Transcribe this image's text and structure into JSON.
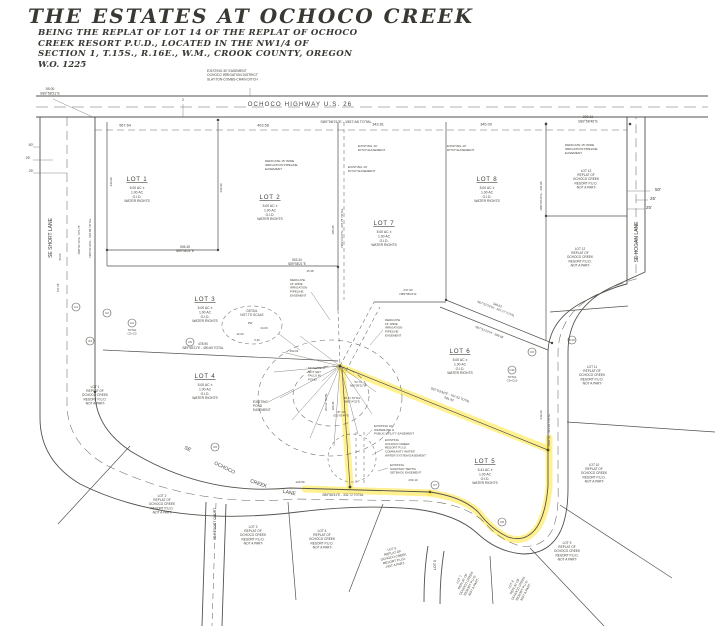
{
  "colors": {
    "paper": "#ffffff",
    "ink": "#55524c",
    "highlight": "#ffe84a"
  },
  "title_block": {
    "title": "THE ESTATES AT OCHOCO CREEK",
    "line1": "BEING THE REPLAT OF LOT 14 OF THE REPLAT OF OCHOCO",
    "line2": "CREEK RESORT P.U.D., LOCATED IN THE NW1/4 OF",
    "line3": "SECTION 1, T.15S., R.16E., W.M., CROOK COUNTY, OREGON",
    "line4": "W.O. 1225"
  },
  "map_labels": [
    {
      "n": "road-ochoco-highway-label",
      "t": "OCHOCO HIGHWAY U.S. 26",
      "x": 300,
      "y": 106,
      "s": 6,
      "ls": 1.2
    },
    {
      "n": "bearing-highway-total",
      "t": "S89°58'21\"E  -  1557.68 TOTAL",
      "x": 346,
      "y": 123,
      "s": 3.8
    },
    {
      "n": "dim-567-64",
      "t": "567.64",
      "x": 125,
      "y": 126.5,
      "s": 3.8
    },
    {
      "n": "dim-403-58",
      "t": "403.58",
      "x": 263,
      "y": 126.5,
      "s": 3.8
    },
    {
      "n": "dim-343-81",
      "t": "343.81",
      "x": 378,
      "y": 125.5,
      "s": 3.8
    },
    {
      "n": "dim-345-00",
      "t": "345.00",
      "x": 486,
      "y": 125.5,
      "s": 3.8
    },
    {
      "n": "dim-200-11",
      "lines": [
        "200.11",
        "S89°58'46\"E"
      ],
      "x": 588,
      "y": 118,
      "s": 3.5
    },
    {
      "n": "dim-55-00",
      "lines": [
        "55.00",
        "S89°58'21\"E"
      ],
      "x": 50,
      "y": 90,
      "s": 3.5
    },
    {
      "n": "callout-2",
      "t": "2",
      "x": 183,
      "y": 101,
      "s": 3.6
    },
    {
      "n": "easement-oid-30",
      "lines": [
        "EXISTING 30' EASEMENT",
        "OCHOCO IRRIGATION DISTRICT",
        "SLAYTON-COMBS-CRAIN DITCH"
      ],
      "x": 207,
      "y": 72,
      "s": 3.3,
      "a": "start"
    },
    {
      "n": "road-se-short-lane-label",
      "t": "SE SHORT LANE",
      "x": 52,
      "y": 238,
      "s": 5,
      "r": -90
    },
    {
      "n": "road-se-hogan-lane-label",
      "t": "SE HOGAN LANE",
      "x": 638,
      "y": 242,
      "s": 5,
      "r": -90
    },
    {
      "n": "road-se-ochoco-creek-lane-label-1",
      "t": "SE",
      "x": 187,
      "y": 450,
      "s": 5,
      "r": 28
    },
    {
      "n": "road-se-ochoco-creek-lane-label-2",
      "t": "OCHOCO",
      "x": 224,
      "y": 469,
      "s": 5,
      "r": 26
    },
    {
      "n": "road-se-ochoco-creek-lane-label-3",
      "t": "CREEK",
      "x": 258,
      "y": 485,
      "s": 5,
      "r": 20
    },
    {
      "n": "road-se-ochoco-creek-lane-label-4",
      "t": "LANE",
      "x": 289,
      "y": 494,
      "s": 5,
      "r": 12
    },
    {
      "n": "road-se-resort-court-label",
      "t": "SE RESORT COURT",
      "x": 216,
      "y": 524,
      "s": 3.4,
      "r": -90
    },
    {
      "n": "road-lot6-label",
      "t": "LOT 6",
      "x": 436,
      "y": 565,
      "s": 3.6,
      "r": -90
    },
    {
      "n": "lot-1-label",
      "lines": [
        "LOT 1",
        "5.00 AC ±",
        "1.00 AC",
        "O.I.D.",
        "WATER RIGHTS"
      ],
      "x": 137,
      "y": 181,
      "s": 6.2,
      "s2": 3.4,
      "u": true
    },
    {
      "n": "lot-2-label",
      "lines": [
        "LOT 2",
        "5.00 AC ±",
        "1.00 AC",
        "O.I.D.",
        "WATER RIGHTS"
      ],
      "x": 270,
      "y": 199,
      "s": 6.2,
      "s2": 3.4,
      "u": true
    },
    {
      "n": "lot-3-label",
      "lines": [
        "LOT 3",
        "5.00 AC ±",
        "1.00 AC",
        "O.I.D.",
        "WATER RIGHTS"
      ],
      "x": 205,
      "y": 301,
      "s": 6.2,
      "s2": 3.4,
      "u": true
    },
    {
      "n": "lot-4-label",
      "lines": [
        "LOT 4",
        "5.00 AC ±",
        "1.00 AC",
        "O.I.D.",
        "WATER RIGHTS"
      ],
      "x": 205,
      "y": 378,
      "s": 6.2,
      "s2": 3.4,
      "u": true
    },
    {
      "n": "lot-5-label",
      "lines": [
        "LOT 5",
        "5.41 AC ±",
        "1.00 AC",
        "O.I.D.",
        "WATER RIGHTS"
      ],
      "x": 485,
      "y": 463,
      "s": 6.2,
      "s2": 3.4,
      "u": true
    },
    {
      "n": "lot-6-label",
      "lines": [
        "LOT 6",
        "5.00 AC ±",
        "1.00 AC",
        "O.I.D.",
        "WATER RIGHTS"
      ],
      "x": 460,
      "y": 353,
      "s": 6.2,
      "s2": 3.4,
      "u": true
    },
    {
      "n": "lot-7-label",
      "lines": [
        "LOT 7",
        "5.00 AC ±",
        "1.00 AC",
        "O.I.D.",
        "WATER RIGHTS"
      ],
      "x": 384,
      "y": 225,
      "s": 6.2,
      "s2": 3.4,
      "u": true
    },
    {
      "n": "lot-8-label",
      "lines": [
        "LOT 8",
        "5.00 AC ±",
        "1.00 AC",
        "O.I.D.",
        "WATER RIGHTS"
      ],
      "x": 487,
      "y": 181,
      "s": 6.2,
      "s2": 3.4,
      "u": true
    },
    {
      "n": "adjacent-lot-13-label",
      "lines": [
        "LOT 13",
        "REPLAT OF",
        "OCHOCO CREEK",
        "RESORT P.U.D.",
        "-NOT A PART-"
      ],
      "x": 586,
      "y": 172,
      "s": 3.2
    },
    {
      "n": "adjacent-lot-12-label",
      "lines": [
        "LOT 12",
        "REPLAT OF",
        "OCHOCO CREEK",
        "RESORT P.U.D.",
        "-NOT A PART-"
      ],
      "x": 580,
      "y": 250,
      "s": 3.2
    },
    {
      "n": "adjacent-lot-11-label",
      "lines": [
        "LOT 11",
        "REPLAT OF",
        "OCHOCO CREEK",
        "RESORT P.U.D.",
        "-NOT A PART-"
      ],
      "x": 592,
      "y": 368,
      "s": 3.2
    },
    {
      "n": "adjacent-lot-10-label",
      "lines": [
        "LOT 10",
        "REPLAT OF",
        "OCHOCO CREEK",
        "RESORT P.U.D.",
        "-NOT A PART-"
      ],
      "x": 594,
      "y": 466,
      "s": 3.2
    },
    {
      "n": "adjacent-lot-9-label",
      "lines": [
        "LOT 9",
        "REPLAT OF",
        "OCHOCO CREEK",
        "RESORT P.U.D.",
        "-NOT A PART-"
      ],
      "x": 567,
      "y": 544,
      "s": 3.2
    },
    {
      "n": "adjacent-lot-8-label",
      "lines": [
        "LOT 8",
        "REPLAT OF",
        "OCHOCO CREEK",
        "RESORT P.U.D.",
        "-NOT A PART-"
      ],
      "x": 512,
      "y": 585,
      "s": 3.2,
      "r": -62
    },
    {
      "n": "adjacent-lot-7-label",
      "lines": [
        "LOT 7",
        "REPLAT OF",
        "OCHOCO CREEK",
        "RESORT P.U.D.",
        "-NOT A PART-"
      ],
      "x": 460,
      "y": 580,
      "s": 3.2,
      "r": -62
    },
    {
      "n": "adjacent-lot-5-label",
      "lines": [
        "LOT 5",
        "REPLAT OF",
        "OCHOCO CREEK",
        "RESORT P.U.D.",
        "-NOT A PART-"
      ],
      "x": 392,
      "y": 550,
      "s": 3.2,
      "r": -12
    },
    {
      "n": "adjacent-lot-4-label",
      "lines": [
        "LOT 4",
        "REPLAT OF",
        "OCHOCO CREEK",
        "RESORT P.U.D.",
        "-NOT A PART-"
      ],
      "x": 322,
      "y": 532,
      "s": 3.2
    },
    {
      "n": "adjacent-lot-3-label",
      "lines": [
        "LOT 3",
        "REPLAT OF",
        "OCHOCO CREEK",
        "RESORT P.U.D.",
        "-NOT A PART-"
      ],
      "x": 253,
      "y": 528,
      "s": 3.2
    },
    {
      "n": "adjacent-lot-2-label",
      "lines": [
        "LOT 2",
        "REPLAT OF",
        "OCHOCO CREEK",
        "RESORT P.U.D.",
        "-NOT A PART-"
      ],
      "x": 162,
      "y": 497,
      "s": 3.2
    },
    {
      "n": "adjacent-lot-1-label",
      "lines": [
        "LOT 1",
        "REPLAT OF",
        "OCHOCO CREEK",
        "RESORT P.U.D.",
        "-NOT A PART-"
      ],
      "x": 95,
      "y": 388,
      "s": 3.2
    },
    {
      "n": "dim-50-left",
      "t": "50'",
      "x": 31,
      "y": 146,
      "s": 3.6
    },
    {
      "n": "dim-25-left-a",
      "t": "25'",
      "x": 28,
      "y": 159,
      "s": 3.6
    },
    {
      "n": "dim-25-left-b",
      "t": "25'",
      "x": 31,
      "y": 172,
      "s": 3.6
    },
    {
      "n": "dim-50-right",
      "t": "50'",
      "x": 658,
      "y": 191,
      "s": 4.6
    },
    {
      "n": "dim-25-right-a",
      "t": "25'",
      "x": 653,
      "y": 200,
      "s": 4.6
    },
    {
      "n": "dim-25-right-b",
      "t": "25'",
      "x": 649,
      "y": 209,
      "s": 4.6
    },
    {
      "n": "easement-irrigation-topleft",
      "lines": [
        "DEDICATE 15' WIDE",
        "IRRIGATION PIPELINE",
        "EASEMENT"
      ],
      "x": 265,
      "y": 162,
      "s": 3.1,
      "a": "start"
    },
    {
      "n": "easement-ditch-a",
      "lines": [
        "EXISTING 10'",
        "DITCH EASEMENT"
      ],
      "x": 358,
      "y": 147,
      "s": 3.1,
      "a": "start"
    },
    {
      "n": "easement-ditch-b",
      "lines": [
        "EXISTING 10'",
        "DITCH EASEMENT"
      ],
      "x": 348,
      "y": 168,
      "s": 3.1,
      "a": "start"
    },
    {
      "n": "easement-ditch-c",
      "lines": [
        "EXISTING 10'",
        "DITCH EASEMENT"
      ],
      "x": 447,
      "y": 147,
      "s": 3.1,
      "a": "start"
    },
    {
      "n": "easement-irrigation-topright",
      "lines": [
        "DEDICATE 15' WIDE",
        "IRRIGATION PIPELINE",
        "EASEMENT"
      ],
      "x": 565,
      "y": 146,
      "s": 3.1,
      "a": "start"
    },
    {
      "n": "easement-irrigation-center-a",
      "lines": [
        "DEDICATE",
        "15' WIDE",
        "IRRIGATION",
        "PIPELINE",
        "EASEMENT"
      ],
      "x": 290,
      "y": 281,
      "s": 3,
      "a": "start"
    },
    {
      "n": "easement-irrigation-center-b",
      "lines": [
        "DEDICATE",
        "15' WIDE",
        "IRRIGATION",
        "PIPELINE",
        "EASEMENT"
      ],
      "x": 385,
      "y": 321,
      "s": 3,
      "a": "start"
    },
    {
      "n": "monument-note",
      "lines": [
        "MONUMENT",
        "NOT SET",
        "FALLS IN",
        "POND"
      ],
      "x": 308,
      "y": 369,
      "s": 3,
      "a": "start"
    },
    {
      "n": "easement-pond",
      "lines": [
        "EXISTING",
        "POND",
        "EASEMENT"
      ],
      "x": 253,
      "y": 403,
      "s": 3.2,
      "a": "start"
    },
    {
      "n": "easement-waterline",
      "lines": [
        "EXISTING 10'",
        "WATERLINE &",
        "PUBLIC UTILITY EASEMENT"
      ],
      "x": 374,
      "y": 427,
      "s": 3,
      "a": "start"
    },
    {
      "n": "easement-community-water",
      "lines": [
        "EXISTING",
        "OCHOCO CREEK",
        "RESORT P.U.D.",
        "COMMUNITY WATER",
        "WATER SYSTEM EASEMENT"
      ],
      "x": 385,
      "y": 441,
      "s": 3,
      "a": "start"
    },
    {
      "n": "easement-septic",
      "lines": [
        "EXISTING",
        "SANITARY SEPTIC",
        "SETBACK EASEMENT"
      ],
      "x": 390,
      "y": 466,
      "s": 3,
      "a": "start"
    },
    {
      "n": "detail-note",
      "lines": [
        "DETAIL",
        "NOT TO SCALE"
      ],
      "x": 252,
      "y": 312,
      "s": 3.2
    },
    {
      "n": "detail-pw",
      "t": "PW",
      "x": 250,
      "y": 324,
      "s": 2.8
    },
    {
      "n": "detail-24",
      "t": "24.00",
      "x": 264,
      "y": 329,
      "s": 2.8
    },
    {
      "n": "detail-12",
      "t": "12.00",
      "x": 240,
      "y": 335,
      "s": 2.8
    },
    {
      "n": "detail-526",
      "t": "5.26",
      "x": 257,
      "y": 341,
      "s": 2.8
    },
    {
      "n": "bearing-505-45",
      "lines": [
        "505.45",
        "S89°58'21\"E"
      ],
      "x": 185,
      "y": 248,
      "s": 3.2
    },
    {
      "n": "bearing-503-34",
      "lines": [
        "503.34",
        "S89°58'21\"E"
      ],
      "x": 297,
      "y": 261,
      "s": 3.2
    },
    {
      "n": "bearing-478-90",
      "lines": [
        "478.90",
        "S89°58'21\"E  -  490.65 TOTAL"
      ],
      "x": 203,
      "y": 345,
      "s": 3.2
    },
    {
      "n": "bearing-332-72",
      "t": "S89°58'41\"E - 332.72 TOTAL",
      "x": 343,
      "y": 496,
      "s": 3.2
    },
    {
      "n": "dim-129-59",
      "t": "129.59",
      "x": 300,
      "y": 483,
      "s": 3
    },
    {
      "n": "dim-233-13",
      "t": "233.13",
      "x": 413,
      "y": 481,
      "s": 3
    },
    {
      "n": "bearing-n00-23",
      "t": "N00°23'27\"E - 307.75 TOTAL",
      "x": 343,
      "y": 228,
      "s": 3,
      "r": -90
    },
    {
      "n": "dim-180-95",
      "t": "180.95",
      "x": 334,
      "y": 230,
      "s": 3,
      "r": -90
    },
    {
      "n": "bearing-n00-09",
      "t": "N00°09'34\"E - 430.98",
      "x": 542,
      "y": 196,
      "s": 3,
      "r": -90
    },
    {
      "n": "bearing-n00-01-14",
      "t": "N00°01'14\"E - 576.75",
      "x": 80,
      "y": 240,
      "s": 3,
      "r": -90
    },
    {
      "n": "bearing-n00-01-29",
      "t": "N00°01'29\"E - 618.88 TOTAL",
      "x": 91,
      "y": 238,
      "s": 3,
      "r": -90
    },
    {
      "n": "dim-430-99-a",
      "t": "430.99",
      "x": 112,
      "y": 182,
      "s": 3,
      "r": -90
    },
    {
      "n": "dim-430-99-b",
      "t": "430.99",
      "x": 222,
      "y": 188,
      "s": 3,
      "r": -90
    },
    {
      "n": "dim-56-00",
      "t": "56.00",
      "x": 61,
      "y": 257,
      "s": 2.8,
      "r": -90
    },
    {
      "n": "dim-137-18",
      "t": "137.18",
      "x": 59,
      "y": 288,
      "s": 2.8,
      "r": -90
    },
    {
      "n": "bearing-n67-a",
      "lines": [
        "348.53",
        "N67°51'23\"W - 407.27 TOTAL"
      ],
      "x": 497,
      "y": 306,
      "s": 3,
      "r": 21
    },
    {
      "n": "bearing-n67-b",
      "t": "N67°51'23\"W - 368.68",
      "x": 489,
      "y": 333,
      "s": 3,
      "r": 21
    },
    {
      "n": "bearing-s67-highlighted",
      "lines": [
        "S67°03'34\"E - 797.52 TOTAL",
        "581.92"
      ],
      "x": 450,
      "y": 396,
      "s": 3.2,
      "r": 19
    },
    {
      "n": "bearing-north-431",
      "t": "NORTH - 431.93 TOTAL",
      "x": 550,
      "y": 430,
      "s": 3,
      "r": -90
    },
    {
      "n": "dim-349-40",
      "t": "349.40",
      "x": 542,
      "y": 415,
      "s": 3,
      "r": -90
    },
    {
      "n": "bearing-237-93",
      "lines": [
        "237.93",
        "N89°58'21\"E"
      ],
      "x": 408,
      "y": 291,
      "s": 3
    },
    {
      "n": "dim-54-73",
      "lines": [
        "54.73",
        "N00°08'21\"W"
      ],
      "x": 358,
      "y": 383,
      "s": 2.8
    },
    {
      "n": "dim-45-41",
      "lines": [
        "45.41 TOTAL",
        "N89°14'32\"E"
      ],
      "x": 352,
      "y": 399,
      "s": 2.8
    },
    {
      "n": "dim-87-13",
      "lines": [
        "87.13",
        "S01°03'44\"E"
      ],
      "x": 341,
      "y": 413,
      "s": 2.8
    },
    {
      "n": "dim-192-02",
      "t": "192.02",
      "x": 294,
      "y": 352,
      "s": 2.8
    },
    {
      "n": "dim-15-38",
      "t": "15.38",
      "x": 310,
      "y": 272,
      "s": 2.8
    },
    {
      "n": "dim-263-12",
      "t": "263.12 TOTAL",
      "x": 327,
      "y": 402,
      "s": 2.8,
      "r": -90
    },
    {
      "n": "dim-183-38",
      "t": "183.38",
      "x": 334,
      "y": 406,
      "s": 2.8,
      "r": -90
    },
    {
      "n": "note-c4-total",
      "lines": [
        "TOTAL",
        "C2+C3"
      ],
      "x": 132,
      "y": 331,
      "s": 2.9
    },
    {
      "n": "note-c11-total",
      "lines": [
        "TOTAL",
        "C9+C10"
      ],
      "x": 512,
      "y": 378,
      "s": 2.9
    }
  ],
  "curve_markers": [
    {
      "n": "curve-marker-c1",
      "t": "C1",
      "x": 76,
      "y": 307
    },
    {
      "n": "curve-marker-c2",
      "t": "C2",
      "x": 107,
      "y": 313
    },
    {
      "n": "curve-marker-c3",
      "t": "C3",
      "x": 90,
      "y": 341
    },
    {
      "n": "curve-marker-c4",
      "t": "C4",
      "x": 132,
      "y": 323
    },
    {
      "n": "curve-marker-c5",
      "t": "C5",
      "x": 190,
      "y": 342
    },
    {
      "n": "curve-marker-c6",
      "t": "C6",
      "x": 215,
      "y": 447
    },
    {
      "n": "curve-marker-c7",
      "t": "C7",
      "x": 435,
      "y": 485
    },
    {
      "n": "curve-marker-c8",
      "t": "C8",
      "x": 502,
      "y": 522
    },
    {
      "n": "curve-marker-c9",
      "t": "C9",
      "x": 532,
      "y": 352
    },
    {
      "n": "curve-marker-c10",
      "t": "C10",
      "x": 572,
      "y": 340
    },
    {
      "n": "curve-marker-c11",
      "t": "C11",
      "x": 512,
      "y": 370
    }
  ]
}
